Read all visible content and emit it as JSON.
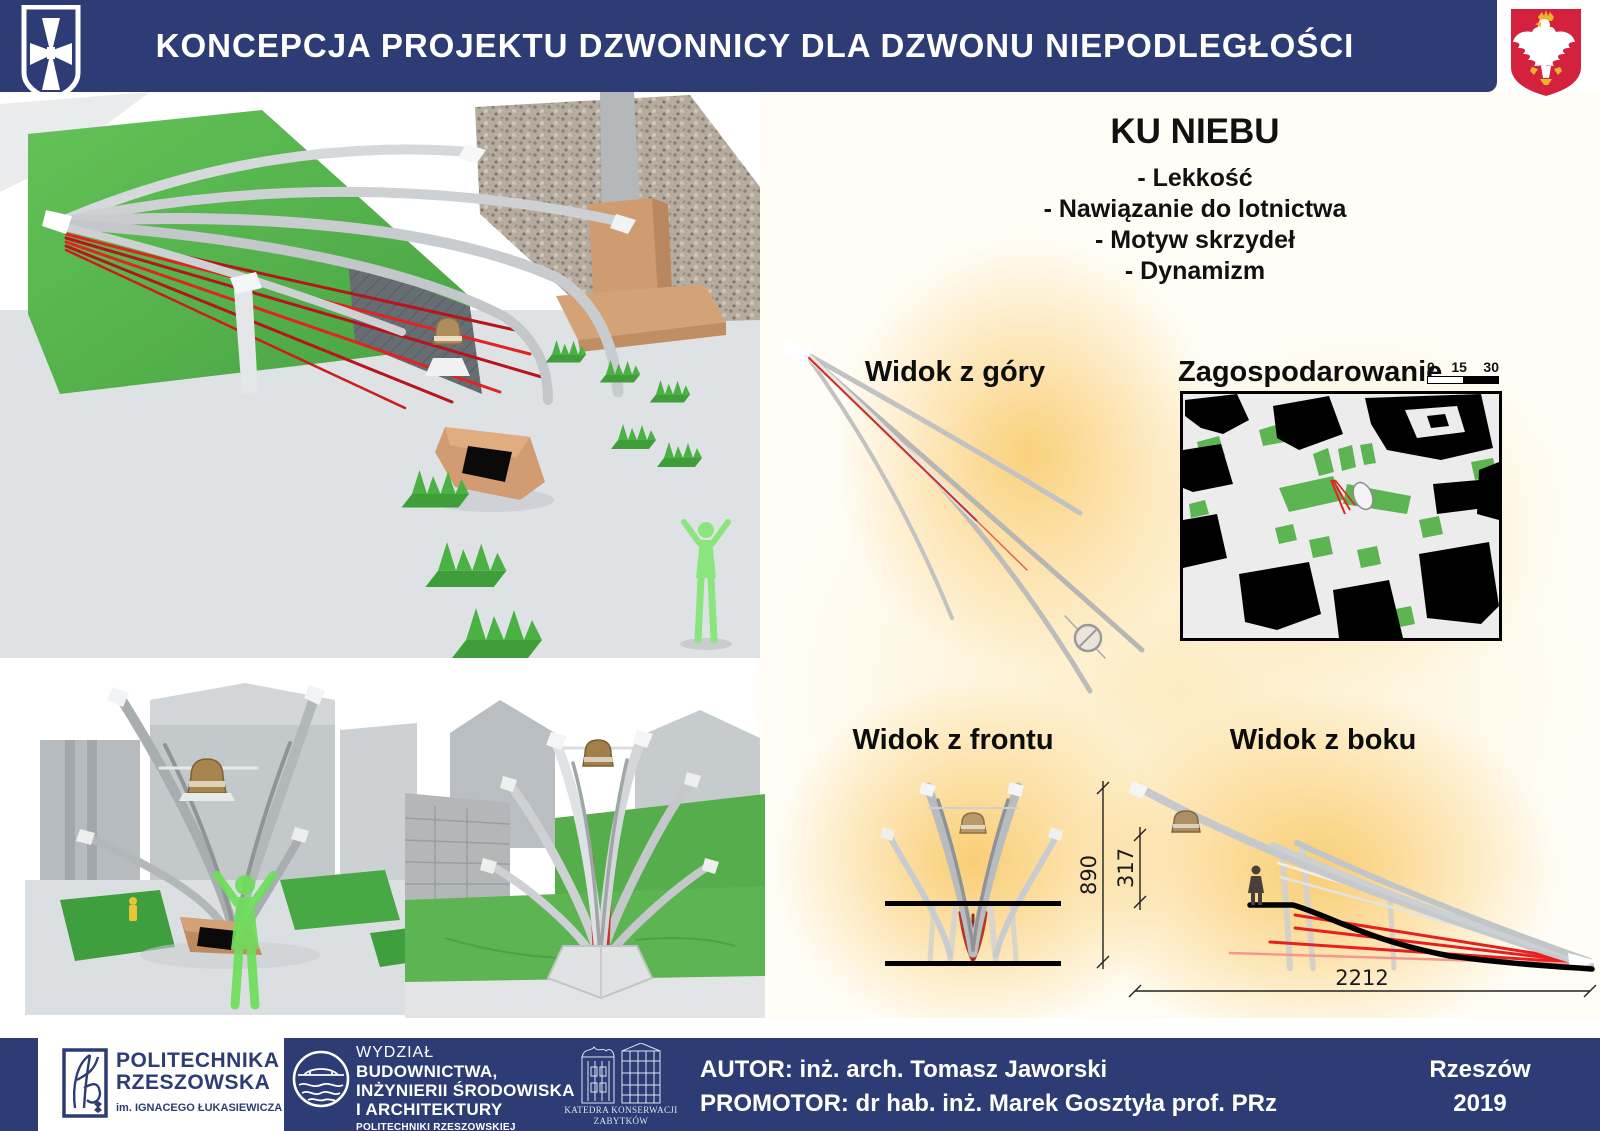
{
  "header": {
    "title": "KONCEPCJA PROJEKTU DZWONNICY DLA DZWONU NIEPODLEGŁOŚCI"
  },
  "concept": {
    "title": "KU NIEBU",
    "bullets": [
      "- Lekkość",
      "- Nawiązanie do lotnictwa",
      "- Motyw skrzydeł",
      "- Dynamizm"
    ]
  },
  "views": {
    "top": {
      "label": "Widok z góry"
    },
    "site_plan": {
      "label": "Zagospodarowanie",
      "scale_ticks": [
        "0",
        "15",
        "30"
      ]
    },
    "front": {
      "label": "Widok z frontu"
    },
    "side": {
      "label": "Widok z boku",
      "dim_height_total": "890",
      "dim_height_partial": "317",
      "dim_width": "2212"
    }
  },
  "footer": {
    "university": {
      "line1": "POLITECHNIKA",
      "line2": "RZESZOWSKA",
      "line3": "im. IGNACEGO ŁUKASIEWICZA"
    },
    "faculty": {
      "line1": "WYDZIAŁ",
      "line2": "BUDOWNICTWA,",
      "line3": "INŻYNIERII ŚRODOWISKA",
      "line4": "I ARCHITEKTURY",
      "line5": "POLITECHNIKI RZESZOWSKIEJ"
    },
    "department": {
      "line1": "KATEDRA KONSERWACJI",
      "line2": "ZABYTKÓW"
    },
    "author_line": "AUTOR: inż. arch. Tomasz Jaworski",
    "promotor_line": "PROMOTOR:  dr hab. inż. Marek Gosztyła prof. PRz",
    "city": "Rzeszów",
    "year": "2019"
  },
  "icons": {
    "city_crest": "rzeszow-cross-shield",
    "state_emblem": "poland-white-eagle",
    "university_logo": "prz-monogram",
    "faculty_logo": "bridge-waves-circle",
    "department_logo": "historic-buildings-lineart",
    "bell": "independence-bell"
  },
  "colors": {
    "navy": "#2d3c74",
    "accent_red": "#e0241f",
    "glow_yellow": "#f9c660",
    "grass_green": "#4db848",
    "map_green": "#5cb551",
    "emblem_red": "#d4213d"
  }
}
